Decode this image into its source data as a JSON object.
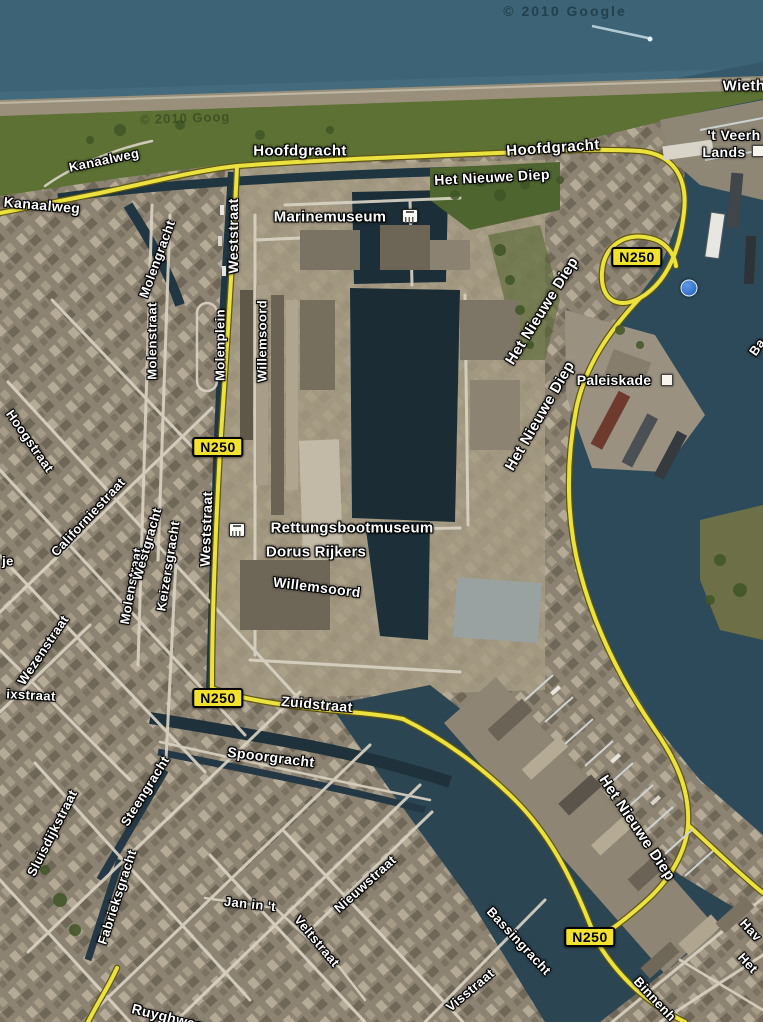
{
  "map": {
    "type": "satellite-map",
    "location_hint": "harbor city aerial view",
    "attribution": "© 2010 Google",
    "route_number": "N250",
    "colors": {
      "sea": "#3c6476",
      "open_water": "#2c4a59",
      "harbor_basin": "#1b2c35",
      "canal": "#203642",
      "grass": "#5c7133",
      "land": "#8d8373",
      "street": "#d8d2c3",
      "route_yellow": "#ece23f",
      "badge_yellow": "#f2e12f",
      "label_text": "#ffffff"
    },
    "labels": [
      {
        "name": "street-label-wieth-fragment",
        "text": "Wieth",
        "x": 744,
        "y": 86,
        "rot": 0,
        "size": 15,
        "kind": "road"
      },
      {
        "name": "poi-label-t-veerh-fragment",
        "text": "'t Veerh",
        "x": 734,
        "y": 135,
        "rot": 0,
        "size": 14,
        "kind": "road"
      },
      {
        "name": "poi-label-lands-fragment",
        "text": "Lands",
        "x": 724,
        "y": 152,
        "rot": 0,
        "size": 14,
        "kind": "road"
      },
      {
        "name": "street-label-hoofdgracht-west",
        "text": "Hoofdgracht",
        "x": 300,
        "y": 151,
        "rot": 0,
        "size": 15,
        "kind": "road"
      },
      {
        "name": "street-label-hoofdgracht-east",
        "text": "Hoofdgracht",
        "x": 553,
        "y": 148,
        "rot": -4,
        "size": 15,
        "kind": "road"
      },
      {
        "name": "water-label-het-nieuwe-diep-top",
        "text": "Het Nieuwe Diep",
        "x": 492,
        "y": 177,
        "rot": -3,
        "size": 14,
        "kind": "road"
      },
      {
        "name": "street-label-kanaalweg-curved",
        "text": "Kanaalweg",
        "x": 104,
        "y": 160,
        "rot": -12,
        "size": 13,
        "kind": "road"
      },
      {
        "name": "street-label-kanaalweg",
        "text": "Kanaalweg",
        "x": 42,
        "y": 205,
        "rot": 5,
        "size": 14,
        "kind": "road"
      },
      {
        "name": "poi-label-marinemuseum",
        "text": "Marinemuseum",
        "x": 330,
        "y": 217,
        "rot": 0,
        "size": 15,
        "kind": "poi"
      },
      {
        "name": "water-label-het-nieuwe-diep-channel-1",
        "text": "Het Nieuwe Diep",
        "x": 542,
        "y": 311,
        "rot": -58,
        "size": 15,
        "kind": "road"
      },
      {
        "name": "water-label-het-nieuwe-diep-channel-2",
        "text": "Het Nieuwe Diep",
        "x": 540,
        "y": 416,
        "rot": -60,
        "size": 15,
        "kind": "road"
      },
      {
        "name": "poi-label-paleiskade",
        "text": "Paleiskade",
        "x": 614,
        "y": 380,
        "rot": 0,
        "size": 14,
        "kind": "poi"
      },
      {
        "name": "route-badge-n250-top",
        "text": "N250",
        "x": 637,
        "y": 257,
        "rot": 0,
        "size": 14,
        "kind": "badge"
      },
      {
        "name": "route-badge-n250-weststraat",
        "text": "N250",
        "x": 218,
        "y": 447,
        "rot": 0,
        "size": 14,
        "kind": "badge"
      },
      {
        "name": "route-badge-n250-zuidstraat",
        "text": "N250",
        "x": 218,
        "y": 698,
        "rot": 0,
        "size": 14,
        "kind": "badge"
      },
      {
        "name": "route-badge-n250-south",
        "text": "N250",
        "x": 590,
        "y": 937,
        "rot": 0,
        "size": 14,
        "kind": "badge"
      },
      {
        "name": "street-label-weststraat-north",
        "text": "Weststraat",
        "x": 233,
        "y": 236,
        "rot": -90,
        "size": 14,
        "kind": "road"
      },
      {
        "name": "street-label-molengracht",
        "text": "Molengracht",
        "x": 157,
        "y": 259,
        "rot": -70,
        "size": 13,
        "kind": "road"
      },
      {
        "name": "street-label-molenstraat-north",
        "text": "Molenstraat",
        "x": 152,
        "y": 341,
        "rot": -90,
        "size": 13,
        "kind": "road"
      },
      {
        "name": "street-label-molenplein",
        "text": "Molenplein",
        "x": 220,
        "y": 345,
        "rot": -90,
        "size": 13,
        "kind": "road"
      },
      {
        "name": "street-label-willemsoord-vertical",
        "text": "Willemsoord",
        "x": 262,
        "y": 341,
        "rot": -90,
        "size": 13,
        "kind": "road"
      },
      {
        "name": "street-label-hoogstraat",
        "text": "Hoogstraat",
        "x": 30,
        "y": 441,
        "rot": 55,
        "size": 13,
        "kind": "road"
      },
      {
        "name": "street-label-californiestraat",
        "text": "Californiestraat",
        "x": 88,
        "y": 517,
        "rot": -47,
        "size": 13,
        "kind": "road"
      },
      {
        "name": "street-label-molenstraat-south",
        "text": "Molenstraat",
        "x": 131,
        "y": 586,
        "rot": -80,
        "size": 13,
        "kind": "road"
      },
      {
        "name": "street-label-westgracht",
        "text": "Westgracht",
        "x": 147,
        "y": 544,
        "rot": -74,
        "size": 13,
        "kind": "road"
      },
      {
        "name": "street-label-keizersgracht",
        "text": "Keizersgracht",
        "x": 168,
        "y": 566,
        "rot": -81,
        "size": 13,
        "kind": "road"
      },
      {
        "name": "street-label-weststraat-south",
        "text": "Weststraat",
        "x": 206,
        "y": 529,
        "rot": -88,
        "size": 14,
        "kind": "road"
      },
      {
        "name": "street-label-wezenstraat",
        "text": "Wezenstraat",
        "x": 43,
        "y": 650,
        "rot": -56,
        "size": 13,
        "kind": "road"
      },
      {
        "name": "street-label-je-fragment",
        "text": "je",
        "x": 8,
        "y": 561,
        "rot": 0,
        "size": 13,
        "kind": "road"
      },
      {
        "name": "street-label-ixstraat-fragment",
        "text": "ixstraat",
        "x": 31,
        "y": 695,
        "rot": 3,
        "size": 13,
        "kind": "road"
      },
      {
        "name": "poi-label-rettungsbootmuseum",
        "text": "Rettungsbootmuseum",
        "x": 352,
        "y": 528,
        "rot": 0,
        "size": 15,
        "kind": "poi"
      },
      {
        "name": "poi-label-dorus-rijkers",
        "text": "Dorus Rijkers",
        "x": 316,
        "y": 552,
        "rot": 0,
        "size": 15,
        "kind": "poi"
      },
      {
        "name": "street-label-willemsoord-curved",
        "text": "Willemsoord",
        "x": 317,
        "y": 587,
        "rot": 7,
        "size": 14,
        "kind": "road"
      },
      {
        "name": "street-label-zuidstraat",
        "text": "Zuidstraat",
        "x": 317,
        "y": 704,
        "rot": 5,
        "size": 14,
        "kind": "road"
      },
      {
        "name": "street-label-spoorgracht",
        "text": "Spoorgracht",
        "x": 271,
        "y": 757,
        "rot": 7,
        "size": 14,
        "kind": "road"
      },
      {
        "name": "street-label-steengracht",
        "text": "Steengracht",
        "x": 145,
        "y": 791,
        "rot": -58,
        "size": 13,
        "kind": "road"
      },
      {
        "name": "street-label-sluisdijkstraat",
        "text": "Sluisdijkstraat",
        "x": 52,
        "y": 833,
        "rot": -63,
        "size": 13,
        "kind": "road"
      },
      {
        "name": "street-label-fabrieksgracht",
        "text": "Fabrieksgracht",
        "x": 117,
        "y": 897,
        "rot": -72,
        "size": 13,
        "kind": "road"
      },
      {
        "name": "street-label-jan-in-t",
        "text": "Jan in 't",
        "x": 250,
        "y": 904,
        "rot": 6,
        "size": 13,
        "kind": "road"
      },
      {
        "name": "street-label-veltstraat",
        "text": "Veltstraat",
        "x": 317,
        "y": 941,
        "rot": 50,
        "size": 13,
        "kind": "road"
      },
      {
        "name": "street-label-nieuwstraat",
        "text": "Nieuwstraat",
        "x": 365,
        "y": 884,
        "rot": -42,
        "size": 13,
        "kind": "road"
      },
      {
        "name": "street-label-bassingracht",
        "text": "Bassingracht",
        "x": 519,
        "y": 941,
        "rot": 47,
        "size": 13,
        "kind": "road"
      },
      {
        "name": "street-label-visstraat",
        "text": "Visstraat",
        "x": 470,
        "y": 990,
        "rot": -40,
        "size": 13,
        "kind": "road"
      },
      {
        "name": "street-label-binnenhaven-fragment",
        "text": "Binnenh",
        "x": 655,
        "y": 999,
        "rot": 47,
        "size": 13,
        "kind": "road"
      },
      {
        "name": "street-label-hav-fragment",
        "text": "Hav",
        "x": 751,
        "y": 930,
        "rot": 47,
        "size": 13,
        "kind": "road"
      },
      {
        "name": "street-label-het-fragment",
        "text": "Het",
        "x": 748,
        "y": 963,
        "rot": 47,
        "size": 13,
        "kind": "road"
      },
      {
        "name": "street-label-ba-fragment",
        "text": "Ba",
        "x": 757,
        "y": 347,
        "rot": -55,
        "size": 13,
        "kind": "road"
      },
      {
        "name": "water-label-het-nieuwe-diep-south",
        "text": "Het Nieuwe Diep",
        "x": 637,
        "y": 828,
        "rot": 56,
        "size": 15,
        "kind": "road"
      },
      {
        "name": "street-label-ruyghweg-fragment",
        "text": "Ruyghweg",
        "x": 168,
        "y": 1017,
        "rot": 14,
        "size": 14,
        "kind": "road"
      },
      {
        "name": "attribution-watermark",
        "text": "© 2010 Google",
        "x": 565,
        "y": 11,
        "rot": 0,
        "size": 14,
        "kind": "watermark"
      },
      {
        "name": "attribution-watermark-grass",
        "text": "© 2010 Goog",
        "x": 185,
        "y": 118,
        "rot": -2,
        "size": 13,
        "kind": "watermark2"
      }
    ],
    "icons": [
      {
        "name": "museum-icon",
        "kind": "museum",
        "x": 410,
        "y": 216
      },
      {
        "name": "museum-icon",
        "kind": "museum",
        "x": 237,
        "y": 530
      },
      {
        "name": "poi-square-icon",
        "kind": "square",
        "x": 667,
        "y": 380
      },
      {
        "name": "poi-square-icon",
        "kind": "square",
        "x": 758,
        "y": 151
      },
      {
        "name": "harbor-icon",
        "kind": "anchor",
        "x": 689,
        "y": 288
      }
    ]
  }
}
